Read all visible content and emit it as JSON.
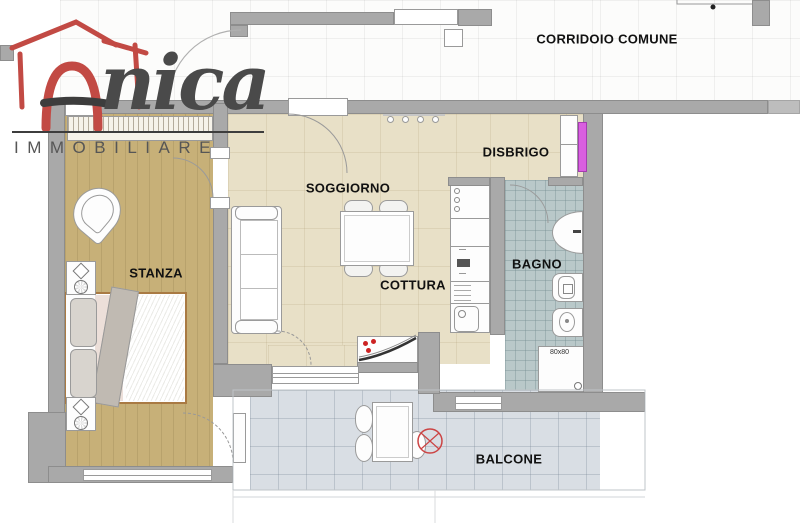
{
  "brand": {
    "script": "nica",
    "tagline": "IMMOBILIARE"
  },
  "rooms": {
    "corridoio": {
      "label": "CORRIDOIO COMUNE"
    },
    "disbrigo": {
      "label": "DISBRIGO"
    },
    "soggiorno": {
      "label": "SOGGIORNO"
    },
    "stanza": {
      "label": "STANZA"
    },
    "cottura": {
      "label": "COTTURA"
    },
    "bagno": {
      "label": "BAGNO"
    },
    "balcone": {
      "label": "BALCONE"
    }
  },
  "fixtures": {
    "shower_size_label": "80x80"
  },
  "colors": {
    "wall": "#a9a9a9",
    "corridor_floor": "#fcfcfb",
    "living_floor": "#e8e0c7",
    "stanza_floor": "#c7b078",
    "bathroom_floor": "#b9c8c9",
    "balcony_floor": "#d9dee4",
    "brand_red": "#c24a44",
    "brand_text": "#4a4a4a",
    "door_marker_magenta": "#d95fe0",
    "hob_dot_red": "#cc2222"
  }
}
